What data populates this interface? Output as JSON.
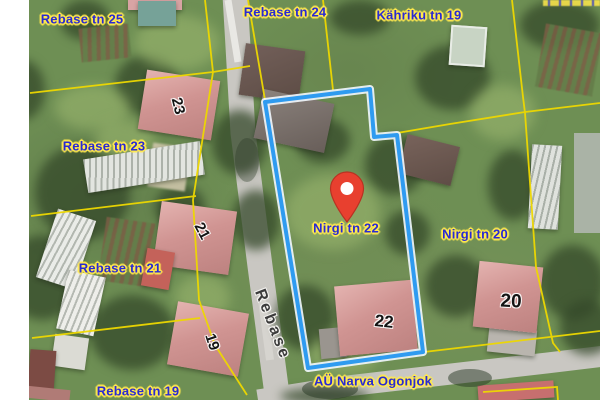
{
  "app": {
    "type": "map-viewer",
    "view": "aerial-cadastral"
  },
  "map": {
    "colors": {
      "parcel_label_text": "#2a2ad2",
      "parcel_label_halo": "#ffe94d",
      "cadastral_line": "#eed800",
      "selected_parcel_line": "#2f9bf0",
      "selected_parcel_casing": "#f2f8ff",
      "marker_red": "#e8402f",
      "marker_border": "#b83222",
      "house_number_text": "#141414",
      "street_label_text": "#3b3b3b",
      "road_fill": "#c9c7c2"
    },
    "selected_parcel": "Nirgi tn 22",
    "labels": [
      {
        "text": "Rebase tn 25"
      },
      {
        "text": "Rebase tn 24"
      },
      {
        "text": "Kähriku tn 19"
      },
      {
        "text": "Rebase tn 23"
      },
      {
        "text": "Rebase tn 21"
      },
      {
        "text": "Rebase tn 19"
      },
      {
        "text": "Nirgi tn 22"
      },
      {
        "text": "Nirgi tn 20"
      },
      {
        "text": "AÜ Narva Ogonjok"
      }
    ],
    "house_numbers": [
      {
        "text": "23"
      },
      {
        "text": "21"
      },
      {
        "text": "19"
      },
      {
        "text": "22"
      },
      {
        "text": "20"
      }
    ],
    "street_label": {
      "text": "Rebase"
    },
    "marker": {
      "kind": "location-pin",
      "at_parcel": "Nirgi tn 22"
    }
  }
}
